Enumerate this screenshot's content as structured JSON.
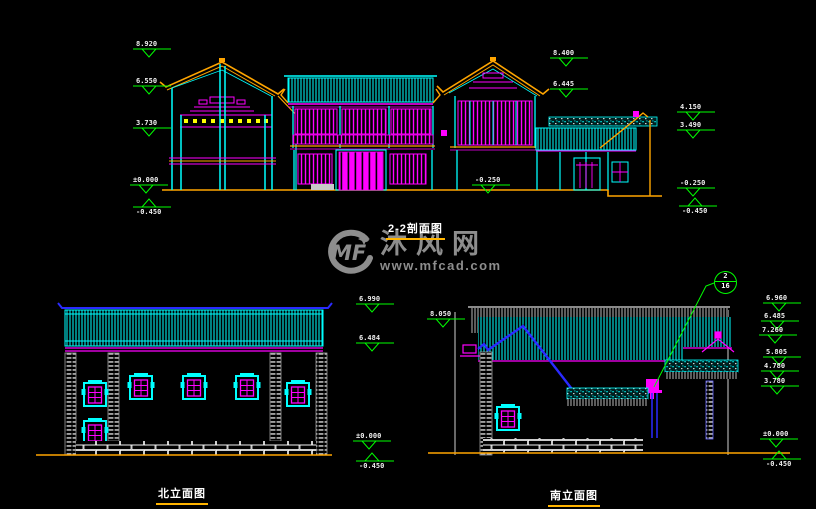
{
  "colors": {
    "background": "#000000",
    "cyan": "#00ffff",
    "magenta": "#ff00ff",
    "orange": "#ffa500",
    "yellow": "#ffff00",
    "green": "#00ff00",
    "blue": "#2a2aff",
    "white": "#ffffff",
    "watermark_gray": "#8d8d8d",
    "title_underline": "#ffb400"
  },
  "watermark": {
    "logo_text": "MF",
    "site_name": "沐风网",
    "site_url": "www.mfcad.com"
  },
  "section_view": {
    "title": "2-2剖面图",
    "markers_left": [
      "8.920",
      "6.550",
      "3.730",
      "±0.000",
      "-0.450"
    ],
    "markers_mid": [
      "8.400",
      "6.445",
      "-0.250"
    ],
    "markers_right": [
      "4.150",
      "3.490",
      "-0.250",
      "-0.450"
    ]
  },
  "north_elevation": {
    "title": "北立面图",
    "markers": [
      "6.990",
      "6.484",
      "±0.000",
      "-0.450"
    ]
  },
  "south_elevation": {
    "title": "南立面图",
    "marker_left": "8.050",
    "markers_right": [
      "6.960",
      "6.485",
      "7.260",
      "5.805",
      "4.780",
      "3.780",
      "±0.000",
      "-0.450"
    ],
    "callout": {
      "number": "2",
      "sheet": "16"
    }
  }
}
